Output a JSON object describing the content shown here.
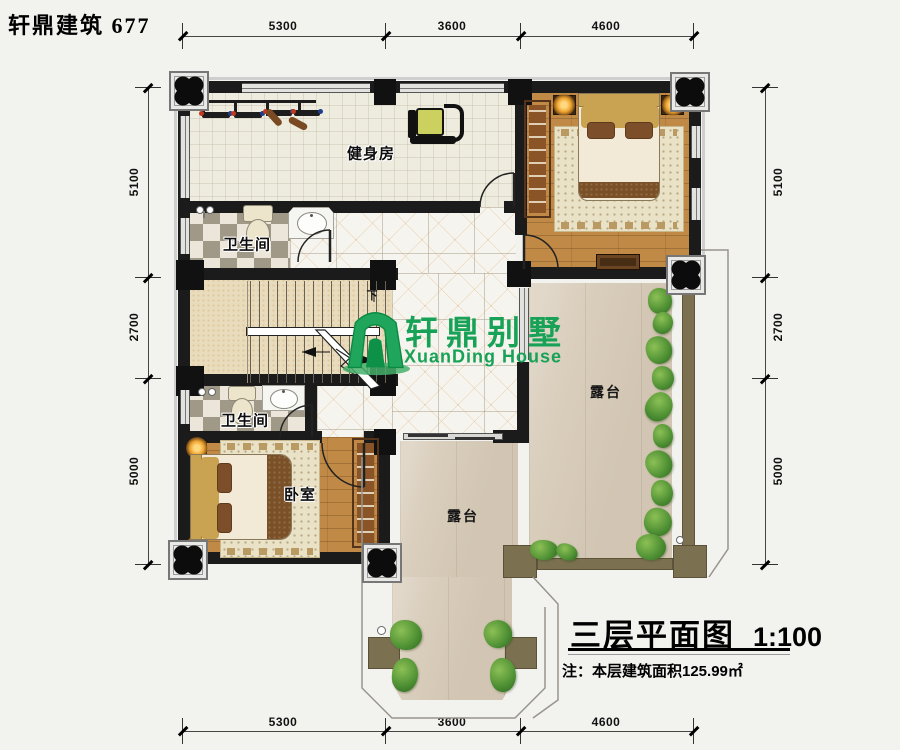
{
  "brand": "轩鼎建筑 677",
  "dims": {
    "top": [
      "5300",
      "3600",
      "4600"
    ],
    "bottom": [
      "5300",
      "3600",
      "4600"
    ],
    "left": [
      "5100",
      "2700",
      "5000"
    ],
    "right": [
      "5100",
      "2700",
      "5000"
    ]
  },
  "rooms": {
    "gym": "健身房",
    "bath1": "卫生间",
    "bath2": "卫生间",
    "bedroom": "卧室",
    "terrace_right": "露台",
    "terrace_bottom": "露台"
  },
  "stairs": {
    "down": "下"
  },
  "logo": {
    "cn": "轩鼎别墅",
    "en": "XuanDing House",
    "color": "#17a257"
  },
  "title": {
    "text": "三层平面图",
    "scale": "1:100",
    "note": "注：本层建筑面积125.99㎡"
  },
  "colors": {
    "wall": "#1b1b1b",
    "wood_floor": "#c08a46",
    "terrace_floor": "#d9cdbb",
    "railing": "#7b7150",
    "logo_green": "#17a257",
    "checker_dark": "#a19988",
    "checker_light": "#ebe6d9"
  }
}
